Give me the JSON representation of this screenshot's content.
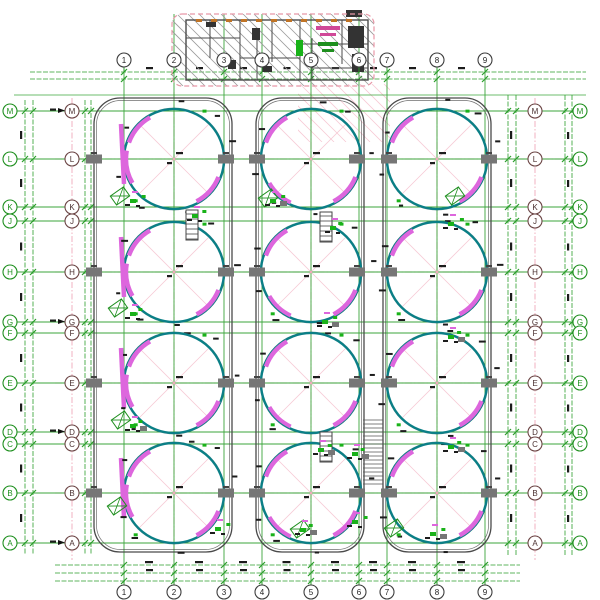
{
  "drawing": {
    "kind": "cad-plan",
    "description": "tank-farm-plan-with-detail-section"
  },
  "colors": {
    "grid_green": "#2b9e2b",
    "rail_green": "#2b9e2b",
    "pink": "#f0a9ba",
    "pink_light": "#f7c9d4",
    "pink_border": "#e898a8",
    "violet": "#dd66dd",
    "teal": "#0a7f86",
    "teal_dark": "#2b6b6e",
    "outline": "#4a4a4a",
    "pier": "#767676",
    "hatch": "#9a9a9a",
    "fixture_green": "#19b219",
    "orange": "#c07426",
    "magenta_text": "#d04898",
    "bubble_dark": "#3c3c3c",
    "bubble_green": "#1e8f1e",
    "bubble_red": "#6b4444",
    "noise": "#1c1c1c"
  },
  "axes": {
    "col_labels": [
      "1",
      "2",
      "3",
      "4",
      "5",
      "6",
      "7",
      "8",
      "9"
    ],
    "col_x": [
      124,
      174,
      224,
      262,
      311,
      359,
      387,
      437,
      485
    ],
    "top_bubble_y": 60,
    "bottom_bubble_y": 592,
    "row_letters": [
      "M",
      "L",
      "K",
      "J",
      "H",
      "G",
      "F",
      "E",
      "D",
      "C",
      "B",
      "A"
    ],
    "row_y": [
      111,
      159,
      207,
      221,
      272,
      322,
      333,
      383,
      432,
      444,
      493,
      543
    ],
    "left_outer_x": 10,
    "left_inner_x": 72,
    "right_inner_x": 535,
    "right_outer_x": 580,
    "arrow_rows_y": [
      111,
      322,
      432,
      543
    ]
  },
  "tanks": {
    "col_x": [
      174,
      311,
      437
    ],
    "row_y": [
      159,
      272,
      383,
      493
    ],
    "radius": 50
  },
  "enclosures": [
    {
      "x1": 94,
      "y1": 98,
      "x2": 232,
      "y2": 552,
      "r": 26
    },
    {
      "x1": 256,
      "y1": 98,
      "x2": 364,
      "y2": 552,
      "r": 26
    },
    {
      "x1": 383,
      "y1": 98,
      "x2": 491,
      "y2": 552,
      "r": 26
    }
  ],
  "pier_wall_x": [
    94,
    226,
    257,
    357,
    389,
    489
  ],
  "pink_vertical_joints_x": [
    72,
    535
  ],
  "rails": {
    "top_y": [
      72,
      79
    ],
    "bottom_y": [
      565,
      573,
      581
    ],
    "left_x": [
      25,
      33,
      85,
      91
    ],
    "right_x": [
      508,
      516,
      565,
      572
    ]
  },
  "wedges": {
    "upper_left": [
      200,
      240
    ],
    "lower_right": [
      22,
      62
    ],
    "col1_left_extra": [
      150,
      190
    ],
    "col2_lower_left": [
      115,
      150
    ]
  },
  "corridor_strip_x": 121,
  "rung_strip": {
    "x1": 363,
    "x2": 383,
    "y1": 420,
    "y2": 486,
    "step": 4
  },
  "ladders": [
    {
      "x": 186,
      "y": 210,
      "w": 12,
      "h": 30
    },
    {
      "x": 320,
      "y": 212,
      "w": 12,
      "h": 30
    },
    {
      "x": 320,
      "y": 432,
      "w": 12,
      "h": 30
    }
  ],
  "stair_boxes": [
    {
      "x": 120,
      "y": 196
    },
    {
      "x": 118,
      "y": 308
    },
    {
      "x": 121,
      "y": 420
    },
    {
      "x": 117,
      "y": 506
    },
    {
      "x": 268,
      "y": 198
    },
    {
      "x": 394,
      "y": 528
    },
    {
      "x": 300,
      "y": 529
    },
    {
      "x": 455,
      "y": 196
    }
  ],
  "clusters": [
    [
      130,
      199
    ],
    [
      192,
      214
    ],
    [
      270,
      199
    ],
    [
      330,
      226
    ],
    [
      448,
      222
    ],
    [
      130,
      312
    ],
    [
      322,
      320
    ],
    [
      448,
      335
    ],
    [
      130,
      424
    ],
    [
      318,
      448
    ],
    [
      352,
      452
    ],
    [
      448,
      445
    ],
    [
      215,
      527
    ],
    [
      300,
      528
    ],
    [
      352,
      520
    ],
    [
      430,
      532
    ]
  ],
  "detail_building": {
    "border": {
      "x": 172,
      "y": 14,
      "w": 202,
      "h": 72,
      "r": 10
    },
    "outer_wall": {
      "x": 186,
      "y": 20,
      "w": 182,
      "h": 60
    },
    "wall_segments_v": [
      [
        210,
        20,
        58
      ],
      [
        240,
        20,
        80
      ],
      [
        257,
        40,
        80
      ],
      [
        272,
        20,
        62
      ],
      [
        300,
        20,
        80
      ],
      [
        312,
        38,
        80
      ],
      [
        342,
        20,
        64
      ]
    ],
    "wall_segments_h": [
      [
        38,
        186,
        240
      ],
      [
        58,
        240,
        300
      ],
      [
        44,
        300,
        368
      ],
      [
        68,
        312,
        368
      ]
    ],
    "fixtures_black": [
      [
        252,
        28,
        8,
        12
      ],
      [
        348,
        26,
        16,
        22
      ],
      [
        352,
        54,
        12,
        18
      ],
      [
        228,
        60,
        8,
        9
      ],
      [
        262,
        66,
        10,
        6
      ],
      [
        206,
        22,
        10,
        5
      ],
      [
        346,
        10,
        16,
        7
      ]
    ],
    "orange_row_y": 20,
    "orange_x_start": 196,
    "orange_x_end": 360,
    "orange_step": 15,
    "green_fixture": [
      296,
      40,
      7,
      16
    ],
    "magenta_marks": [
      [
        316,
        26,
        24,
        4
      ],
      [
        320,
        33,
        16,
        3
      ]
    ],
    "green_marks": [
      [
        318,
        42,
        20,
        4
      ],
      [
        322,
        49,
        12,
        3
      ]
    ],
    "hatch_spacing": 11,
    "grid_cols_through_x": [
      174,
      224,
      262,
      311,
      359
    ]
  },
  "pink_hatch_region": {
    "x": 298,
    "y": 84,
    "w": 92,
    "h": 58,
    "spacing": 12
  }
}
